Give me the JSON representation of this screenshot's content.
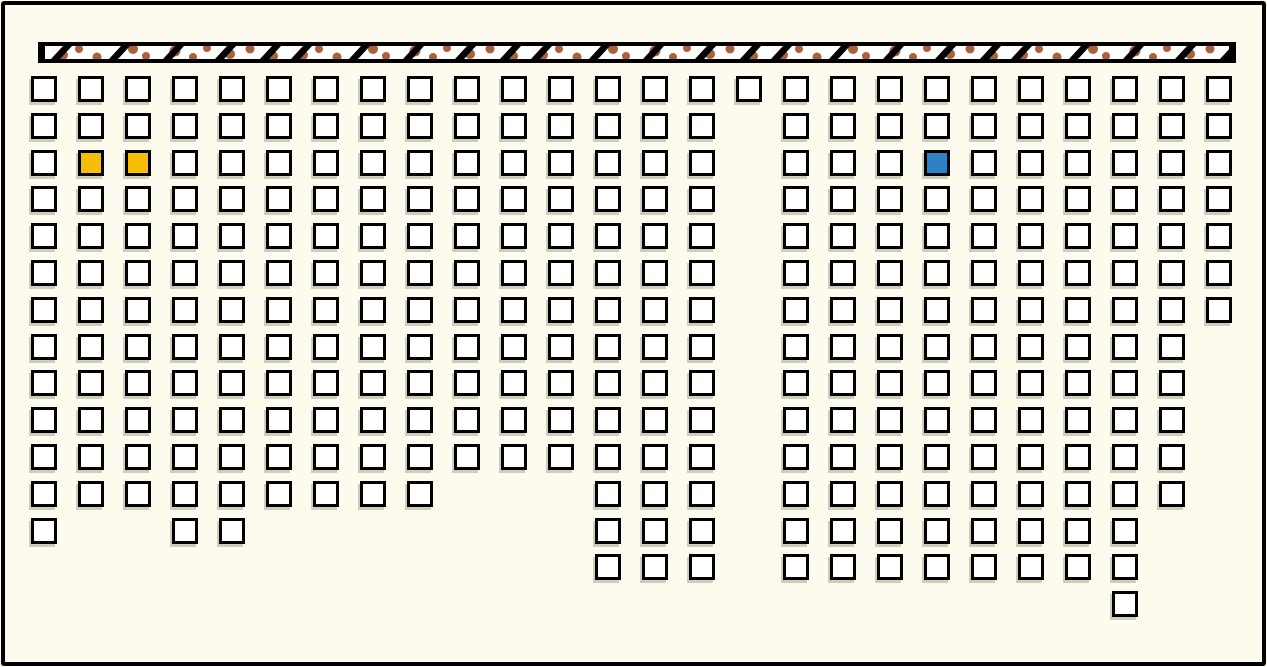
{
  "map": {
    "width": 1267,
    "height": 667,
    "background_color": "#FCFBED",
    "frame_color": "#000000"
  },
  "stage_bar": {
    "x": 38,
    "y": 42,
    "width": 1198,
    "height": 21,
    "border_color": "#000000",
    "band_fill": "#FFFFFF",
    "slash_color": "#000000",
    "speckle_color": "#A9613C"
  },
  "seat_grid": {
    "origin_x": 31,
    "origin_y": 76,
    "pitch_x": 47,
    "pitch_y": 36.8,
    "cell_size": 26,
    "cell_border": 3,
    "default_fill": "#FFFFFF",
    "cell_border_color": "#000000",
    "shadow_color": "#969380",
    "columns": [
      {
        "col": 0,
        "row_start": 0,
        "row_end": 12
      },
      {
        "col": 1,
        "row_start": 0,
        "row_end": 11
      },
      {
        "col": 2,
        "row_start": 0,
        "row_end": 11
      },
      {
        "col": 3,
        "row_start": 0,
        "row_end": 12
      },
      {
        "col": 4,
        "row_start": 0,
        "row_end": 12
      },
      {
        "col": 5,
        "row_start": 0,
        "row_end": 11
      },
      {
        "col": 6,
        "row_start": 0,
        "row_end": 11
      },
      {
        "col": 7,
        "row_start": 0,
        "row_end": 11
      },
      {
        "col": 8,
        "row_start": 0,
        "row_end": 11
      },
      {
        "col": 9,
        "row_start": 0,
        "row_end": 10
      },
      {
        "col": 10,
        "row_start": 0,
        "row_end": 10
      },
      {
        "col": 11,
        "row_start": 0,
        "row_end": 10
      },
      {
        "col": 12,
        "row_start": 0,
        "row_end": 13
      },
      {
        "col": 13,
        "row_start": 0,
        "row_end": 13
      },
      {
        "col": 14,
        "row_start": 0,
        "row_end": 13
      },
      {
        "col": 15,
        "row_start": 0,
        "row_end": 0
      },
      {
        "col": 16,
        "row_start": 0,
        "row_end": 13
      },
      {
        "col": 17,
        "row_start": 0,
        "row_end": 13
      },
      {
        "col": 18,
        "row_start": 0,
        "row_end": 13
      },
      {
        "col": 19,
        "row_start": 0,
        "row_end": 13
      },
      {
        "col": 20,
        "row_start": 0,
        "row_end": 13
      },
      {
        "col": 21,
        "row_start": 0,
        "row_end": 13
      },
      {
        "col": 22,
        "row_start": 0,
        "row_end": 13
      },
      {
        "col": 23,
        "row_start": 0,
        "row_end": 14
      },
      {
        "col": 24,
        "row_start": 0,
        "row_end": 11
      },
      {
        "col": 25,
        "row_start": 0,
        "row_end": 6
      }
    ],
    "highlighted_seats": [
      {
        "row": 2,
        "col": 1,
        "fill": "#F6BF06",
        "name": "seat-highlight-yellow-1"
      },
      {
        "row": 2,
        "col": 2,
        "fill": "#F6BF06",
        "name": "seat-highlight-yellow-2"
      },
      {
        "row": 2,
        "col": 19,
        "fill": "#2E82C3",
        "name": "seat-highlight-blue"
      }
    ]
  }
}
